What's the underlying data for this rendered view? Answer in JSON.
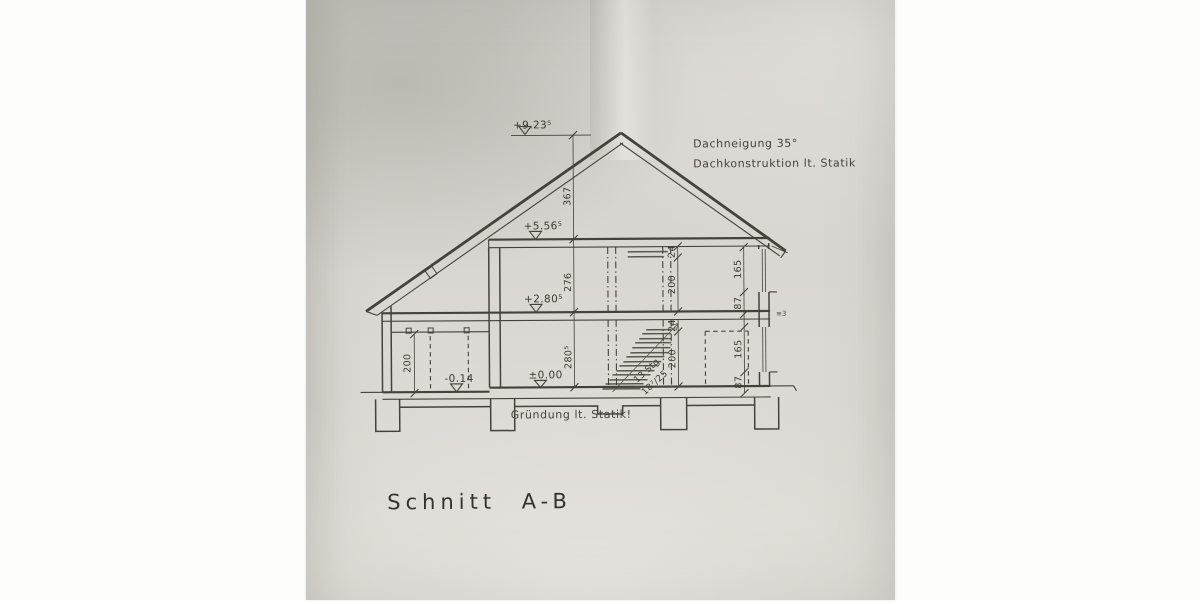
{
  "drawing": {
    "title": "Schnitt A-B",
    "notes": {
      "pitch": "Dachneigung 35°",
      "roof_construction": "Dachkonstruktion lt. Statik",
      "foundation": "Gründung lt. Statik!"
    },
    "levels": {
      "ridge": "+9.23⁵",
      "attic_floor": "+5.56⁵",
      "upper_floor": "+2.80⁵",
      "ground_floor": "±0.00",
      "outside_grade": "-0.14"
    },
    "dims": {
      "ridge_to_attic": "367",
      "upper_storey": "276",
      "ground_storey": "280⁵",
      "upper_lintel": "24",
      "upper_door": "200",
      "ground_lintel": "24",
      "ground_door": "200",
      "upper_window": "165",
      "upper_parapet": "87",
      "ground_window": "165",
      "ground_parapet": "87",
      "carport_door": "200",
      "slab_edge_mark": "≡3"
    },
    "stair": {
      "line1": "13 Stg",
      "line2": "18⁷/25"
    }
  }
}
